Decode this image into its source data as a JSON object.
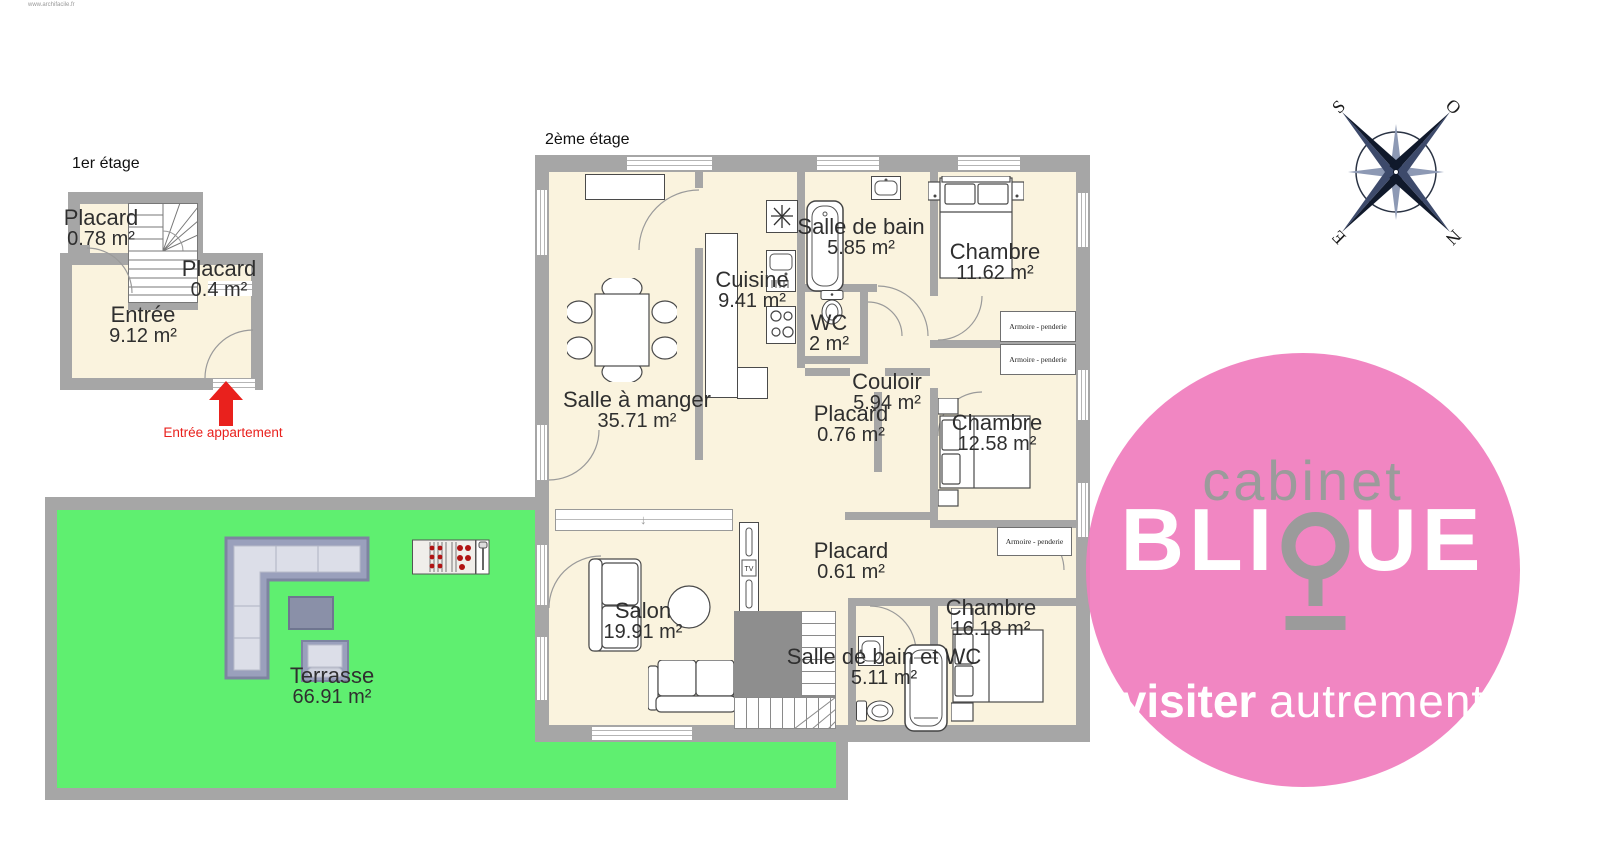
{
  "watermark": "www.archifacile.fr",
  "floor1": {
    "title": "1er étage",
    "rooms": {
      "placard_a": {
        "name": "Placard",
        "area": "0.78 m²"
      },
      "placard_b": {
        "name": "Placard",
        "area": "0.4 m²"
      },
      "entree": {
        "name": "Entrée",
        "area": "9.12 m²"
      }
    },
    "entrance_label": "Entrée appartement"
  },
  "floor2": {
    "title": "2ème étage",
    "rooms": {
      "salle_a_manger": {
        "name": "Salle à manger",
        "area": "35.71 m²"
      },
      "cuisine": {
        "name": "Cuisine",
        "area": "9.41 m²"
      },
      "salle_de_bain": {
        "name": "Salle de bain",
        "area": "5.85 m²"
      },
      "wc": {
        "name": "WC",
        "area": "2 m²"
      },
      "chambre1": {
        "name": "Chambre",
        "area": "11.62 m²"
      },
      "couloir": {
        "name": "Couloir",
        "area": "5.94 m²"
      },
      "placard_c": {
        "name": "Placard",
        "area": "0.76 m²"
      },
      "chambre2": {
        "name": "Chambre",
        "area": "12.58 m²"
      },
      "placard_d": {
        "name": "Placard",
        "area": "0.61 m²"
      },
      "salon": {
        "name": "Salon",
        "area": "19.91 m²"
      },
      "sdb_wc": {
        "name": "Salle de bain et WC",
        "area": "5.11 m²"
      },
      "chambre3": {
        "name": "Chambre",
        "area": "16.18 m²"
      },
      "terrasse": {
        "name": "Terrasse",
        "area": "66.91 m²"
      }
    },
    "wardrobe_label": "Armoire - penderie",
    "tv_label": "TV"
  },
  "compass": {
    "top_left": "S",
    "top_right": "O",
    "bottom_left": "E",
    "bottom_right": "N"
  },
  "logo": {
    "line1": "cabinet",
    "word_left": "BLI",
    "word_right": "UE",
    "tagline_bold": "visiter",
    "tagline_light": "autrement"
  },
  "colors": {
    "floor_fill": "#faf3de",
    "wall_gray": "#a6a6a6",
    "terrace_green": "#5fef70",
    "brand_pink": "#f07dbd",
    "logo_gray": "#9b9b9b",
    "arrow_red": "#e9211d"
  }
}
